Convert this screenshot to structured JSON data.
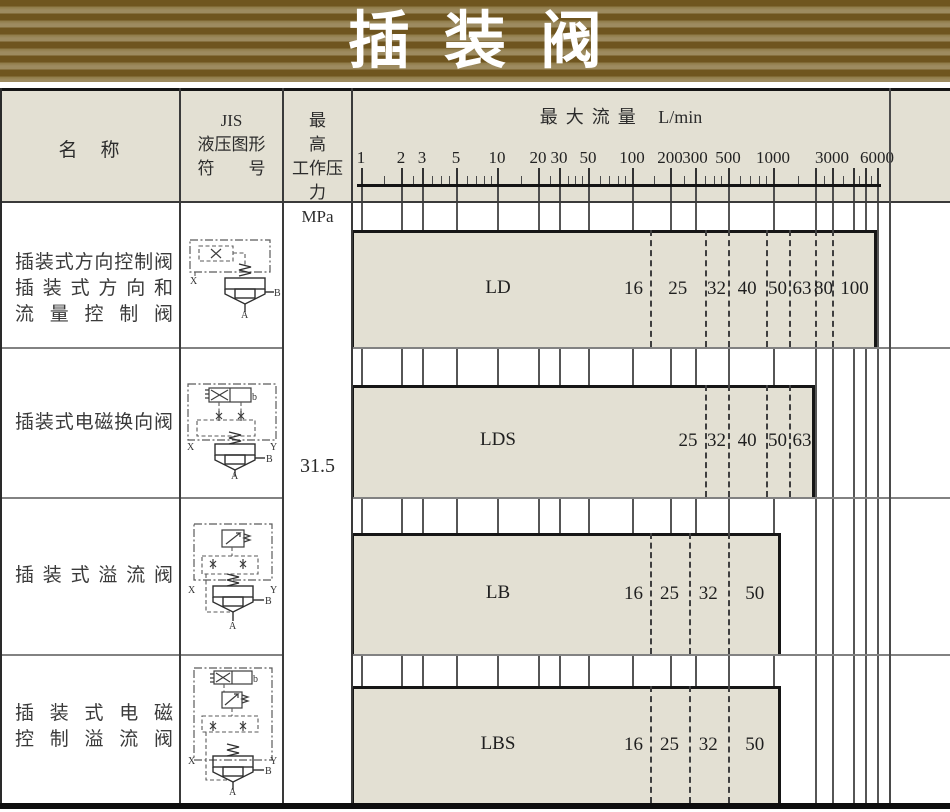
{
  "banner": {
    "title": "插装阀"
  },
  "colors": {
    "banner_dark": "#6f551f",
    "banner_light": "#9d8b60",
    "cell_beige": "#e3e0d3",
    "border_dark": "#161616",
    "separator_gray": "#828282",
    "text": "#2c2c2c"
  },
  "table": {
    "headers": {
      "name": "名　称",
      "symbol_lines": [
        "JIS",
        "液压图形",
        "符　　号"
      ],
      "pressure_lines": [
        "最　　高",
        "工作压力",
        "MPa"
      ],
      "flow_title": "最大流量",
      "flow_unit": "L/min"
    },
    "pressure_value": "31.5",
    "rows": [
      {
        "name_lines": [
          "插装式方向控制阀",
          "插装式方向和",
          "流量控制阀"
        ],
        "model": "LD",
        "ports": {
          "x": "X",
          "b": "B",
          "a": "A"
        }
      },
      {
        "name_lines": [
          "插装式电磁换向阀"
        ],
        "model": "LDS",
        "ports": {
          "x": "X",
          "y": "Y",
          "b": "B",
          "a": "A",
          "sol": "b"
        }
      },
      {
        "name_lines": [
          "插装式溢流阀"
        ],
        "model": "LB",
        "ports": {
          "x": "X",
          "y": "Y",
          "b": "B",
          "a": "A"
        }
      },
      {
        "name_lines": [
          "插装式电磁",
          "控制溢流阀"
        ],
        "model": "LBS",
        "ports": {
          "x": "X",
          "y": "Y",
          "b": "B",
          "a": "A",
          "sol": "b"
        }
      }
    ]
  },
  "chart_data": {
    "type": "bar",
    "subtype": "horizontal-log-range-bars",
    "title": "最大流量 L/min",
    "axis": {
      "title": "最大流量",
      "unit": "L/min",
      "scale": "log",
      "range": [
        1,
        6000
      ],
      "labeled_ticks": [
        1,
        2,
        3,
        5,
        10,
        20,
        30,
        50,
        100,
        200,
        300,
        500,
        1000,
        3000,
        6000
      ],
      "gridline_ticks": [
        1,
        2,
        3,
        5,
        10,
        20,
        30,
        50,
        100,
        200,
        300,
        500,
        1000,
        2000,
        3000,
        4000,
        5000,
        6000
      ],
      "minor_ticks": [
        1.5,
        2.5,
        3.5,
        4,
        4.5,
        6,
        7,
        8,
        9,
        15,
        25,
        35,
        40,
        45,
        60,
        70,
        80,
        90,
        150,
        250,
        350,
        400,
        450,
        600,
        700,
        800,
        900,
        1500,
        2500,
        3500,
        4500,
        5500
      ],
      "anchors_px": [
        [
          1,
          361
        ],
        [
          2,
          401
        ],
        [
          3,
          422
        ],
        [
          5,
          456
        ],
        [
          10,
          497
        ],
        [
          20,
          538
        ],
        [
          30,
          559
        ],
        [
          50,
          588
        ],
        [
          100,
          632
        ],
        [
          200,
          670
        ],
        [
          300,
          695
        ],
        [
          500,
          728
        ],
        [
          1000,
          773
        ],
        [
          2000,
          815
        ],
        [
          3000,
          832
        ],
        [
          4000,
          853
        ],
        [
          5000,
          865
        ],
        [
          6000,
          877
        ]
      ]
    },
    "series": [
      {
        "model": "LD",
        "segments": [
          {
            "size": "16",
            "max_flow": 140
          },
          {
            "size": "25",
            "max_flow": 350
          },
          {
            "size": "32",
            "max_flow": 500
          },
          {
            "size": "40",
            "max_flow": 900
          },
          {
            "size": "50",
            "max_flow": 1300
          },
          {
            "size": "63",
            "max_flow": 2000
          },
          {
            "size": "80",
            "max_flow": 3000
          },
          {
            "size": "100",
            "max_flow": 6000
          }
        ]
      },
      {
        "model": "LDS",
        "segments": [
          {
            "size": "25",
            "max_flow": 350
          },
          {
            "size": "32",
            "max_flow": 500
          },
          {
            "size": "40",
            "max_flow": 900
          },
          {
            "size": "50",
            "max_flow": 1300
          },
          {
            "size": "63",
            "max_flow": 2000
          }
        ]
      },
      {
        "model": "LB",
        "segments": [
          {
            "size": "16",
            "max_flow": 140
          },
          {
            "size": "25",
            "max_flow": 270
          },
          {
            "size": "32",
            "max_flow": 500
          },
          {
            "size": "50",
            "max_flow": 1150
          }
        ]
      },
      {
        "model": "LBS",
        "segments": [
          {
            "size": "16",
            "max_flow": 140
          },
          {
            "size": "25",
            "max_flow": 270
          },
          {
            "size": "32",
            "max_flow": 500
          },
          {
            "size": "50",
            "max_flow": 1150
          }
        ]
      }
    ]
  }
}
